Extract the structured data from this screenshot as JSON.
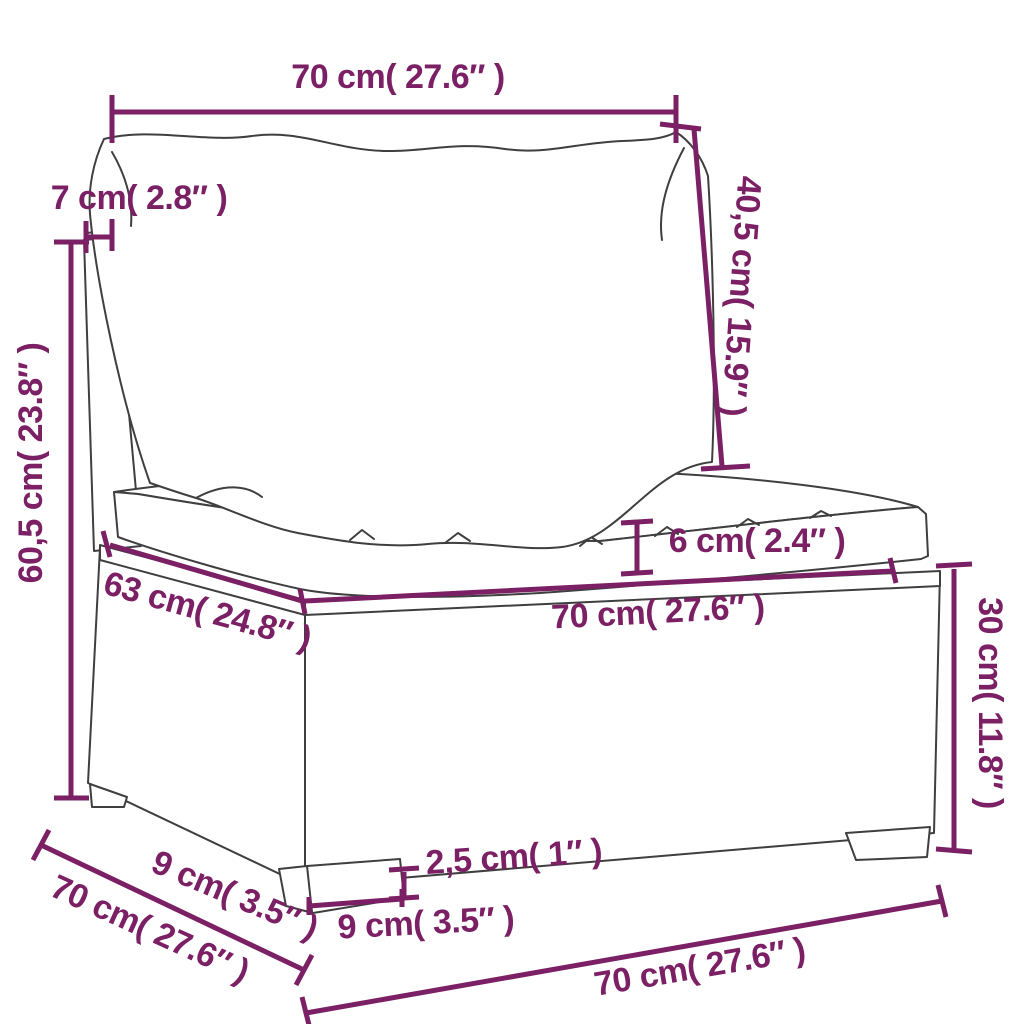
{
  "diagram": {
    "title": "garden-sofa-section-dimension-diagram",
    "colors": {
      "accent": "#7b2064",
      "line_art": "#3f3f3f",
      "background": "#ffffff"
    },
    "units": {
      "metric": "cm",
      "imperial": "inches"
    },
    "dimensions": [
      {
        "id": "back-cushion-width",
        "label": "70 cm( 27.6″ )"
      },
      {
        "id": "back-panel-thickness",
        "label": "7 cm( 2.8″ )"
      },
      {
        "id": "backrest-height",
        "label": "60,5 cm( 23.8″ )"
      },
      {
        "id": "back-cushion-height",
        "label": "40,5 cm( 15.9″ )"
      },
      {
        "id": "seat-cushion-thickness",
        "label": "6 cm( 2.4″ )"
      },
      {
        "id": "seat-width",
        "label": "70 cm( 27.6″ )"
      },
      {
        "id": "seat-depth",
        "label": "63 cm( 24.8″ )"
      },
      {
        "id": "base-height",
        "label": "30 cm( 11.8″ )"
      },
      {
        "id": "side-foot-depth",
        "label": "9 cm( 3.5″ )"
      },
      {
        "id": "side-depth",
        "label": "70 cm( 27.6″ )"
      },
      {
        "id": "foot-height",
        "label": "2,5 cm( 1″ )"
      },
      {
        "id": "front-foot-width",
        "label": "9 cm( 3.5″ )"
      },
      {
        "id": "front-width",
        "label": "70 cm( 27.6″ )"
      }
    ]
  }
}
